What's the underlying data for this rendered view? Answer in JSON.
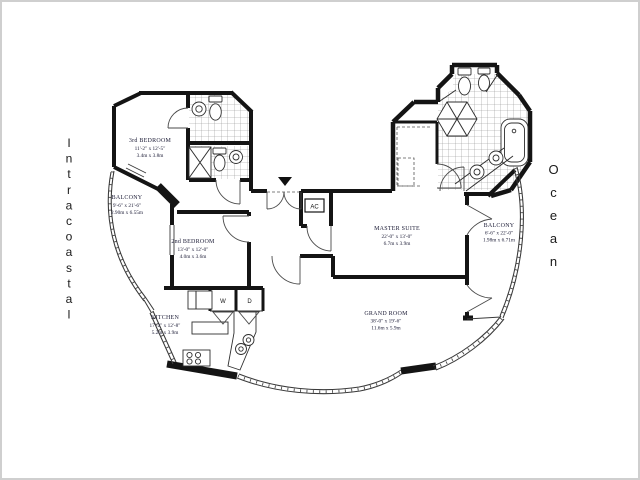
{
  "canvas": {
    "background": "#ffffff",
    "frame_color": "#cfcfcf",
    "wall_color": "#141414",
    "text_color": "#20203a"
  },
  "side_labels": {
    "left": "Intracoastal",
    "right": "Ocean"
  },
  "rooms": {
    "bedroom3": {
      "name": "3rd BEDROOM",
      "dims_ft": "11'-2\" x 12'-5\"",
      "dims_m": "3.4m x 3.8m"
    },
    "balcony_left": {
      "name": "BALCONY",
      "dims_ft": "9'-6\" x 21'-6\"",
      "dims_m": "2.90m x 6.55m"
    },
    "bedroom2": {
      "name": "2nd BEDROOM",
      "dims_ft": "13'-0\" x 12'-0\"",
      "dims_m": "4.0m x 3.6m"
    },
    "kitchen": {
      "name": "KITCHEN",
      "dims_ft": "17'-2\" x 12'-8\"",
      "dims_m": "5.2m x 3.9m"
    },
    "master_suite": {
      "name": "MASTER SUITE",
      "dims_ft": "22'-0\" x 13'-0\"",
      "dims_m": "6.7m x 3.9m"
    },
    "balcony_right": {
      "name": "BALCONY",
      "dims_ft": "6'-6\" x 22'-0\"",
      "dims_m": "1.98m x 6.71m"
    },
    "grand_room": {
      "name": "GRAND ROOM",
      "dims_ft": "38'-0\" x 19'-6\"",
      "dims_m": "11.6m x 5.9m"
    }
  },
  "labels": {
    "ac": "AC",
    "washer": "W",
    "dryer": "D"
  }
}
